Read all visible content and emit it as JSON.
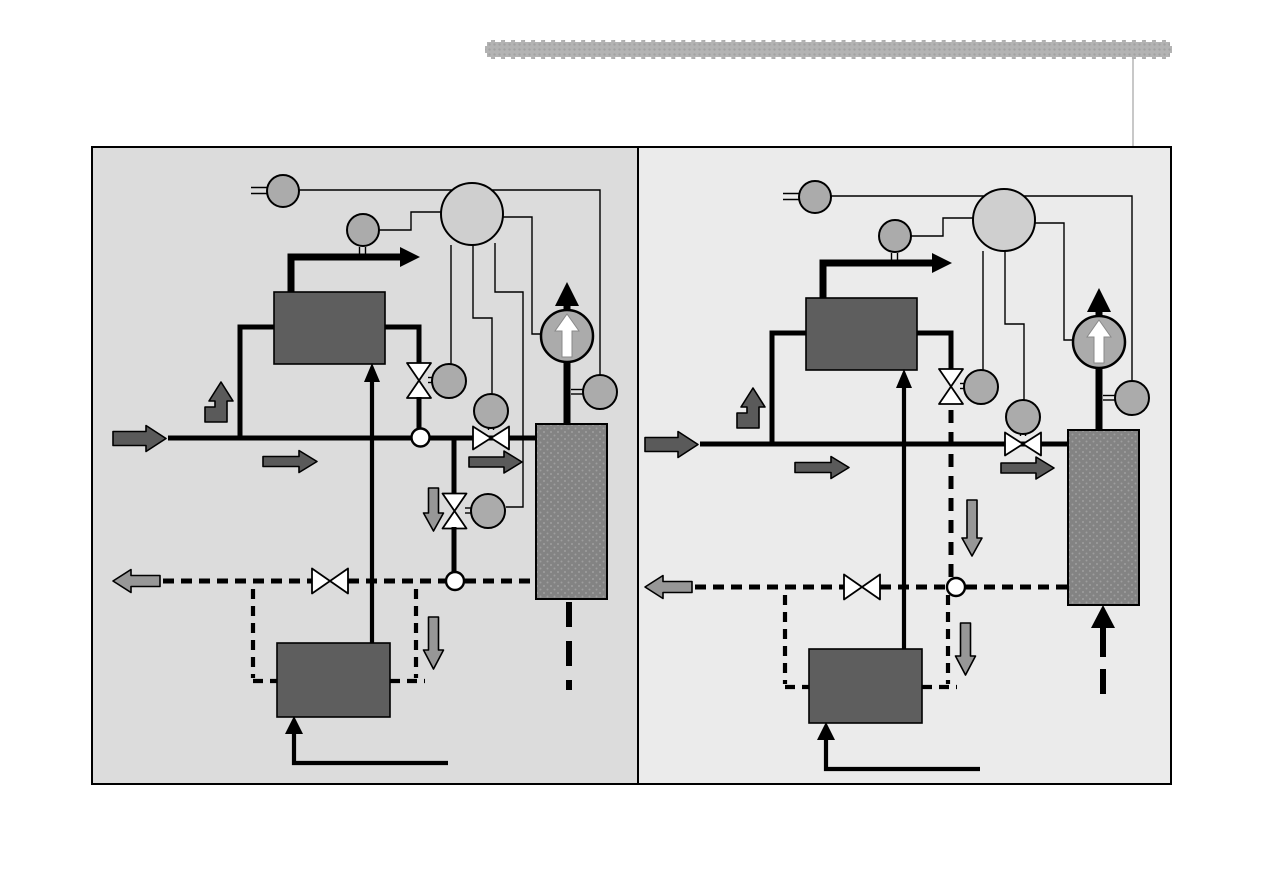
{
  "slide": {
    "title": "",
    "header_bar": {
      "icon": "textured-divider-bar",
      "style": "dotted-texture-with-white-dashed-border"
    },
    "layout": "two-panel process schematic comparison, no visible text labels"
  },
  "colors": {
    "page_bg": "#ffffff",
    "header_fill": "#b3b3b3",
    "header_dot": "#a2a2a2",
    "connector": "#c8c8c8",
    "panel_left_bg": "#dcdcdc",
    "panel_right_bg": "#ebebeb",
    "panel_border": "#000000",
    "line": "#000000",
    "equipment_box": "#5e5e5e",
    "instrument_circle": "#ababab",
    "controller_circle": "#cfcfcf",
    "pump_fill": "#ababab",
    "column_fill": "#838383",
    "column_dot": "#9e9e9e",
    "valve_fill": "#ffffff",
    "junction_fill": "#ffffff",
    "dark_arrow": "#5a5a5a",
    "light_arrow": "#979797",
    "pump_arrow": "#ffffff"
  },
  "panels": [
    {
      "id": "left",
      "components": [
        "controller-circle",
        "sensor-circles",
        "steam-arrow",
        "heat-exchanger-top",
        "vertical-control-valve",
        "main-supply-line",
        "inline-valve-with-actuator",
        "bypass-branch-with-valve",
        "circulation-pump",
        "storage-column",
        "return-line-dashed",
        "return-valve",
        "heat-exchanger-bottom",
        "inlet-arrow",
        "outlet-arrow",
        "flow-direction-arrows",
        "junction-circles"
      ],
      "variant": "bypass branch with second valve and sensor; column outflow dashed downward"
    },
    {
      "id": "right",
      "components": [
        "controller-circle",
        "sensor-circles",
        "steam-arrow",
        "heat-exchanger-top",
        "vertical-control-valve",
        "main-supply-line",
        "inline-valve-with-actuator",
        "dashed-bypass-branch",
        "circulation-pump",
        "storage-column",
        "return-line-dashed",
        "return-valve",
        "heat-exchanger-bottom",
        "inlet-arrow",
        "outlet-arrow",
        "flow-direction-arrows",
        "junction-circles"
      ],
      "variant": "bypass branch shown dashed without valve; column inflow arrow pointing up from dashed line"
    }
  ]
}
